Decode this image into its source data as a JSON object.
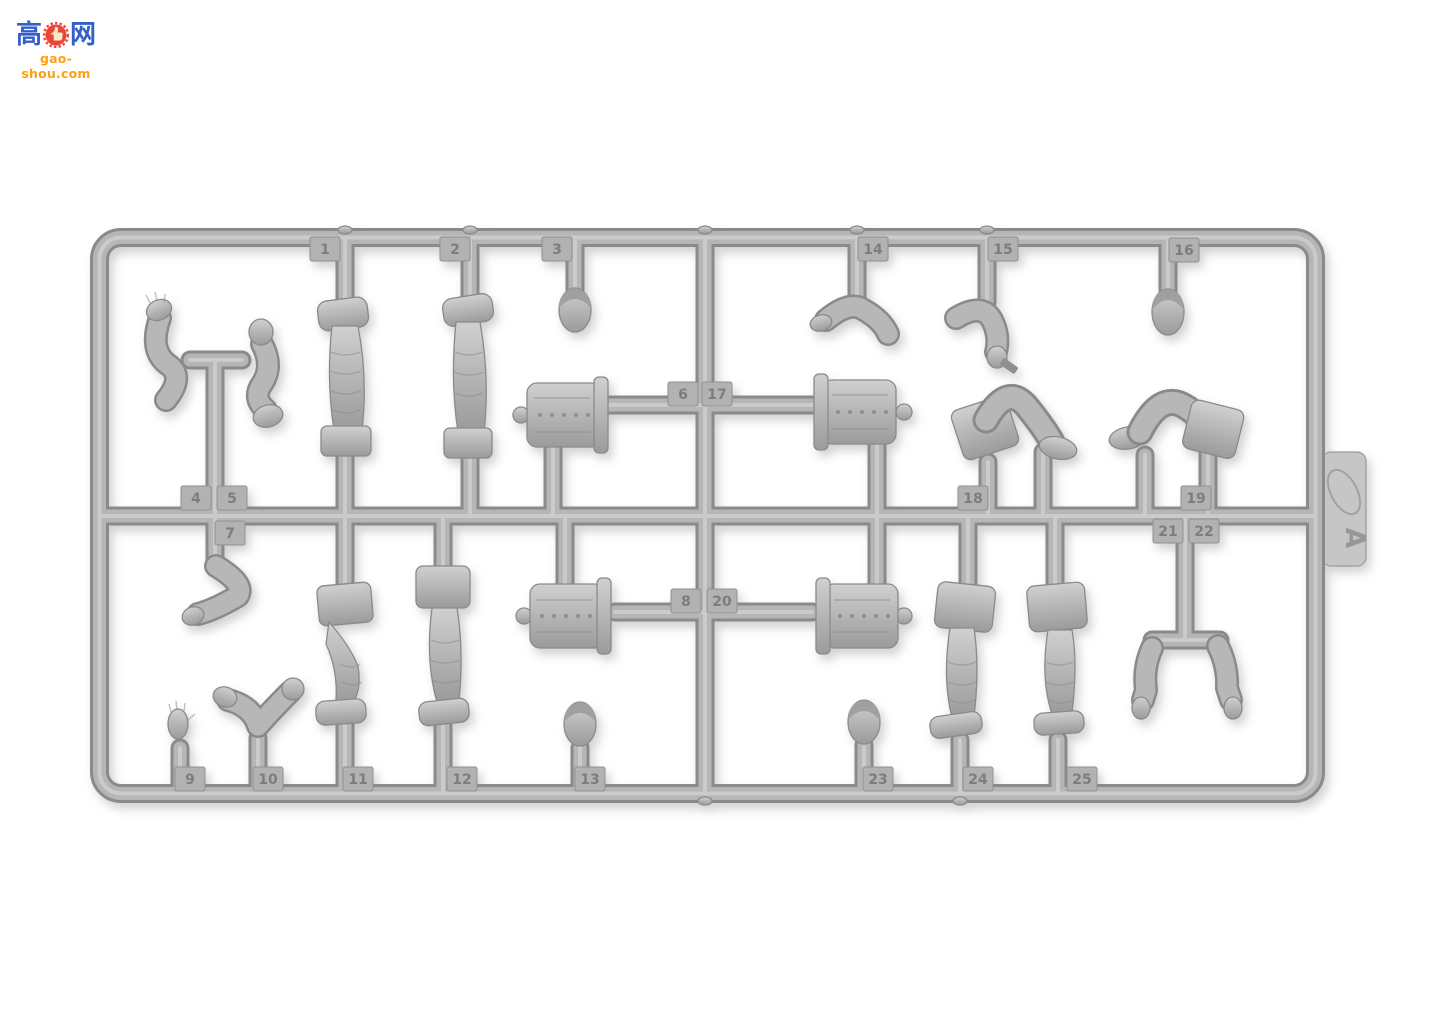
{
  "description": "product photo of a gray plastic injection sprue with numbered figure parts",
  "watermark": {
    "cn_left": "高",
    "cn_right": "网",
    "site": "gao-shou.com",
    "colors": {
      "blue": "#2553c6",
      "orange": "#ff9800",
      "red": "#e8392a"
    }
  },
  "sprue": {
    "letter": "A",
    "plastic_color": "#b6b6b6",
    "background_color": "#ffffff",
    "parts": [
      {
        "no": "1",
        "kind": "leg"
      },
      {
        "no": "2",
        "kind": "leg"
      },
      {
        "no": "3",
        "kind": "head"
      },
      {
        "no": "4",
        "kind": "arm"
      },
      {
        "no": "5",
        "kind": "arm"
      },
      {
        "no": "6",
        "kind": "torso"
      },
      {
        "no": "7",
        "kind": "arm"
      },
      {
        "no": "8",
        "kind": "torso"
      },
      {
        "no": "9",
        "kind": "hand"
      },
      {
        "no": "10",
        "kind": "arm"
      },
      {
        "no": "11",
        "kind": "leg"
      },
      {
        "no": "12",
        "kind": "leg"
      },
      {
        "no": "13",
        "kind": "head"
      },
      {
        "no": "14",
        "kind": "arm"
      },
      {
        "no": "15",
        "kind": "arm"
      },
      {
        "no": "16",
        "kind": "head"
      },
      {
        "no": "17",
        "kind": "torso"
      },
      {
        "no": "18",
        "kind": "legs-bent"
      },
      {
        "no": "19",
        "kind": "legs-bent"
      },
      {
        "no": "20",
        "kind": "torso"
      },
      {
        "no": "21",
        "kind": "arm"
      },
      {
        "no": "22",
        "kind": "arm"
      },
      {
        "no": "23",
        "kind": "head"
      },
      {
        "no": "24",
        "kind": "leg"
      },
      {
        "no": "25",
        "kind": "leg"
      }
    ]
  }
}
